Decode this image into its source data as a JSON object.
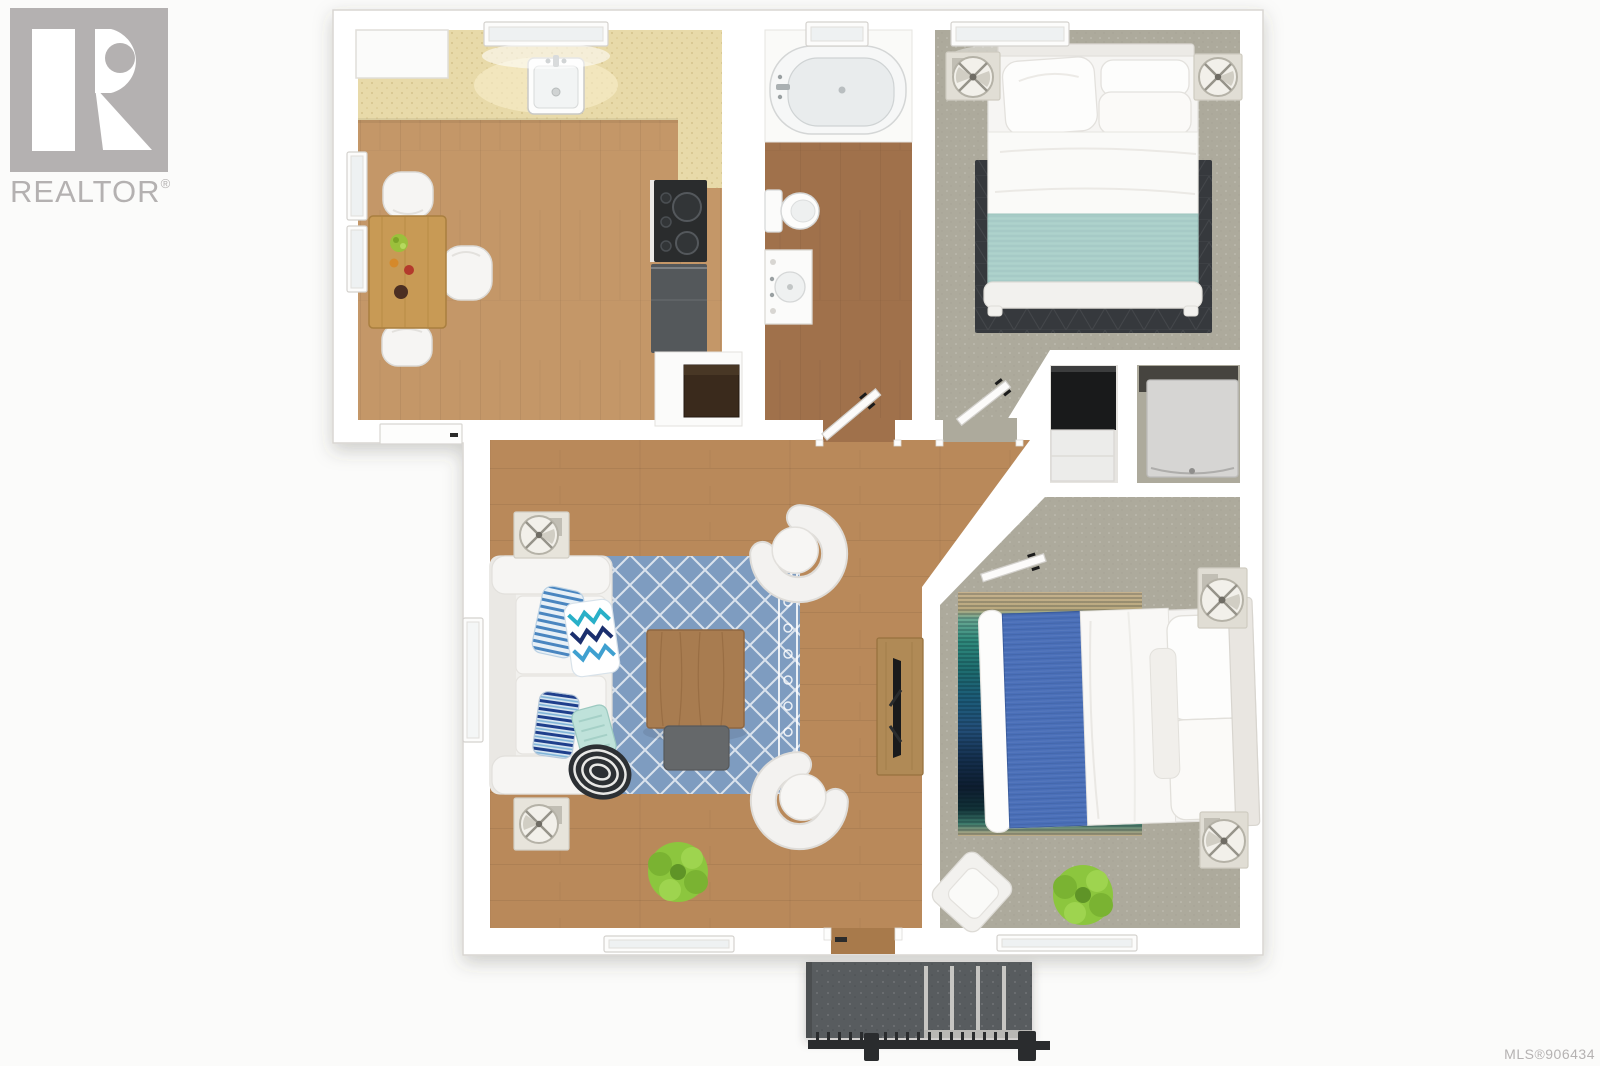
{
  "branding": {
    "logo_text": "REALTOR",
    "registered_mark": "®"
  },
  "footer": {
    "mls_text": "MLS®906434"
  },
  "palette": {
    "bg": "#fbfbfa",
    "wall": "#ffffff",
    "wall_outline": "#d9d6d2",
    "kitchen_floor": "#c49768",
    "bath_floor": "#a0714b",
    "living_floor": "#b9895a",
    "carpet": "#adaa9c",
    "counter": "#e8daa9",
    "rug_blue": "#7e9cc0",
    "rug_dark": "#36393d",
    "teal_blanket": "#abd0ca",
    "blue_blanket": "#4a6fb8",
    "wood_furniture": "#c89a55",
    "dark_appliance": "#2a2c2d",
    "gray_appliance": "#54585b",
    "plant_green": "#8cc63e",
    "porch": "#595c5e",
    "railing": "#2a2c2e",
    "logo_gray": "#b4b1b1",
    "footer_gray": "#b5b2b2"
  }
}
